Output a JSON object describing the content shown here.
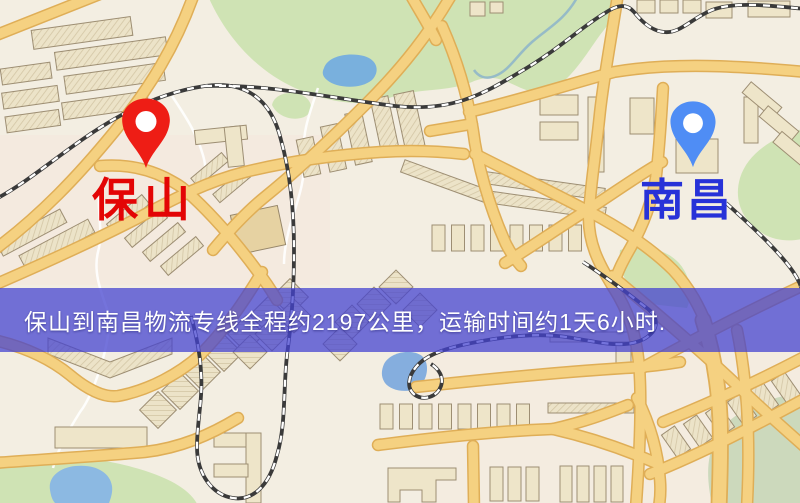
{
  "banner": {
    "text": "保山到南昌物流专线全程约2197公里，运输时间约1天6小时.",
    "distance_km": "2197",
    "transit_time": "1天6小时",
    "bg_color": "#4442d0",
    "text_color": "#ffffff"
  },
  "markers": {
    "origin": {
      "label": "保山",
      "icon": "location-pin-icon",
      "pin_color": "#ee1d15",
      "label_color": "#e30505"
    },
    "destination": {
      "label": "南昌",
      "icon": "location-pin-icon",
      "pin_color": "#4f8df5",
      "label_color": "#2732d8"
    }
  },
  "map_colors": {
    "background": "#f3eee2",
    "road_fill": "#f5d181",
    "road_casing": "#dfae57",
    "park_green": "#cfe3b4",
    "sage_green": "#ccd9bc",
    "water_blue": "#79b0dd",
    "railway": "#3a3a3a",
    "building": "#eee5c9"
  }
}
